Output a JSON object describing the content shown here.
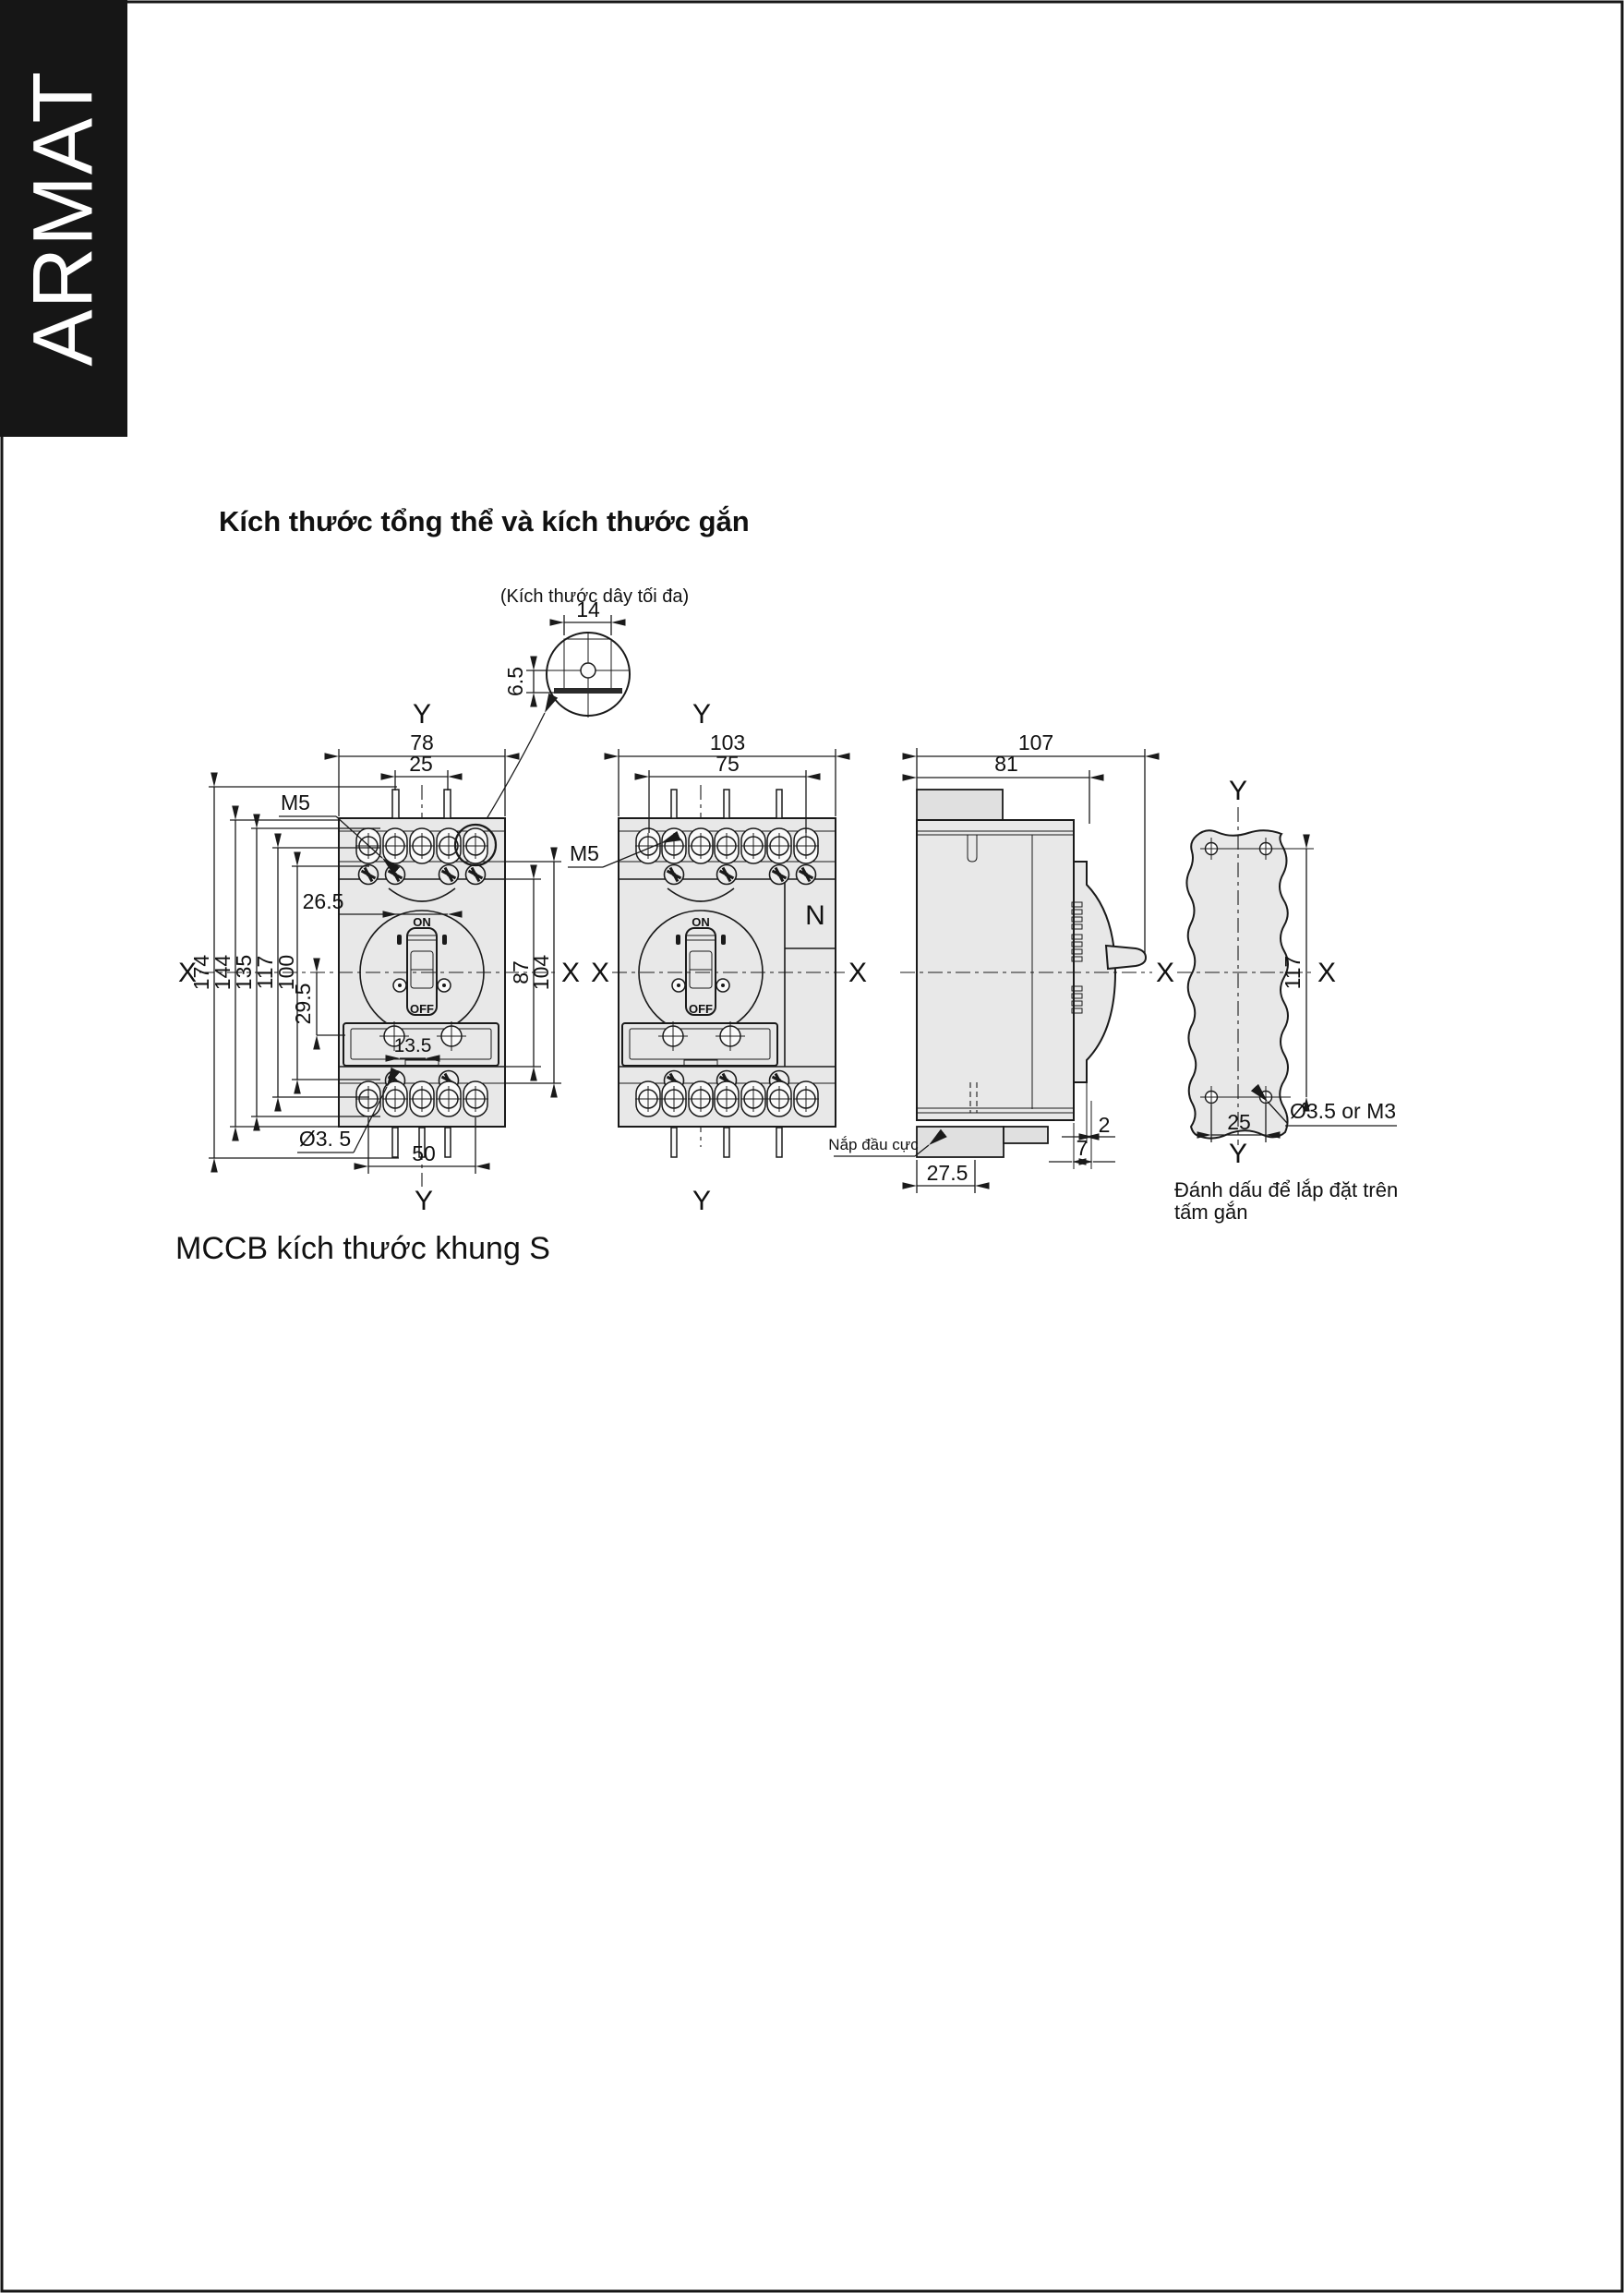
{
  "page": {
    "brand": "ARMAT",
    "title": "Kích thước tổng thể và kích thước gắn",
    "caption": "MCCB kích thước khung S"
  },
  "axis": {
    "x": "X",
    "y": "Y"
  },
  "switch": {
    "on": "ON",
    "off": "OFF"
  },
  "detail": {
    "note": "(Kích thước dây tối đa)",
    "dim_w": "14",
    "dim_h": "6.5"
  },
  "front3p": {
    "dim_width": "78",
    "dim_pins": "25",
    "thread": "M5",
    "dim_handle": "26.5",
    "dim_h_174": "174",
    "dim_h_144": "144",
    "dim_h_135": "135",
    "dim_h_117": "117",
    "dim_h_100": "100",
    "dim_h_29_5": "29.5",
    "dim_panel": "13.5",
    "hole_label": "Ø3. 5",
    "dim_bottom": "50",
    "dim_87": "87",
    "dim_104": "104"
  },
  "front4p": {
    "dim_width": "103",
    "dim_inner": "75",
    "thread": "M5",
    "neutral": "N"
  },
  "side": {
    "dim_depth": "107",
    "dim_inner": "81",
    "dim_gap": "2",
    "dim_step": "7",
    "dim_cover": "27.5",
    "cover_label": "Nắp đầu cực"
  },
  "plate": {
    "dim_height": "117",
    "dim_span": "25",
    "hole_label": "Ø3.5 or M3",
    "caption1": "Đánh dấu để lắp đặt trên",
    "caption2": "tấm gắn"
  }
}
